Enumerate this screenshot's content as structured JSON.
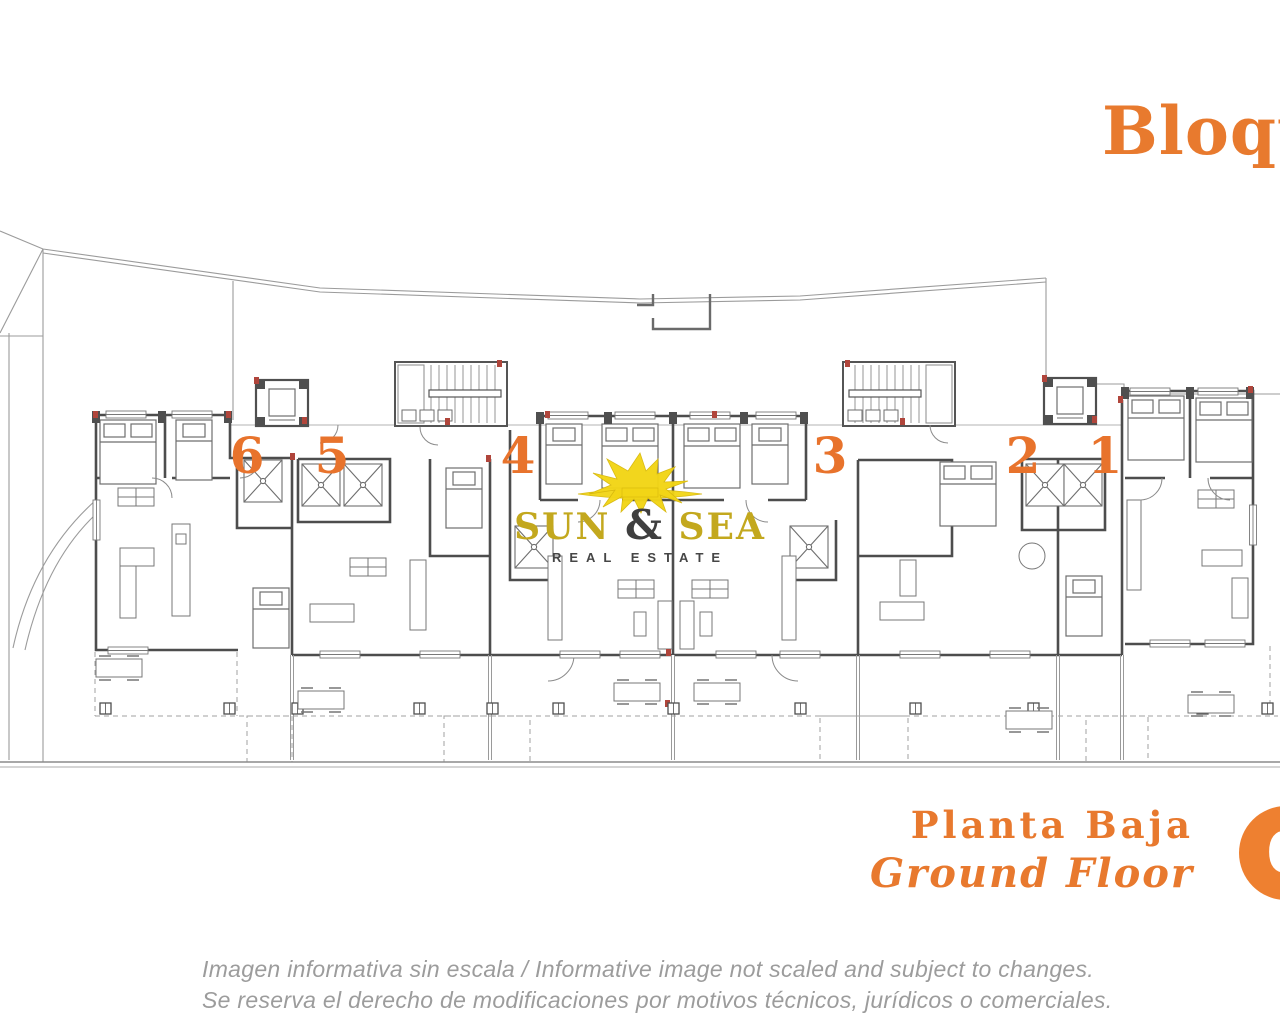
{
  "page": {
    "background": "#ffffff"
  },
  "header": {
    "block_title": "Bloque",
    "accent_color": "#e87a2e"
  },
  "logo": {
    "word1": "SUN",
    "ampersand": "&",
    "word2": "SEA",
    "subtitle": "REAL ESTATE",
    "gold_color": "#c3a81e",
    "dark_color": "#3f3f3f",
    "sun_color": "#f2d516"
  },
  "plan": {
    "unit_labels": [
      "6",
      "5",
      "4",
      "3",
      "2",
      "1"
    ],
    "label_color": "#e8732c",
    "wall_color": "#4d4d4d",
    "boundary_color": "#9b9b9b",
    "red_accent_color": "#b0453b"
  },
  "floor_label": {
    "spanish": "Planta Baja",
    "english": "Ground Floor",
    "badge_number": "0",
    "badge_color": "#ee8030"
  },
  "disclaimer": {
    "line1": "Imagen informativa sin escala /  Informative image not scaled and subject to changes.",
    "line2": "Se reserva el derecho de modificaciones por motivos técnicos, jurídicos o comerciales."
  }
}
